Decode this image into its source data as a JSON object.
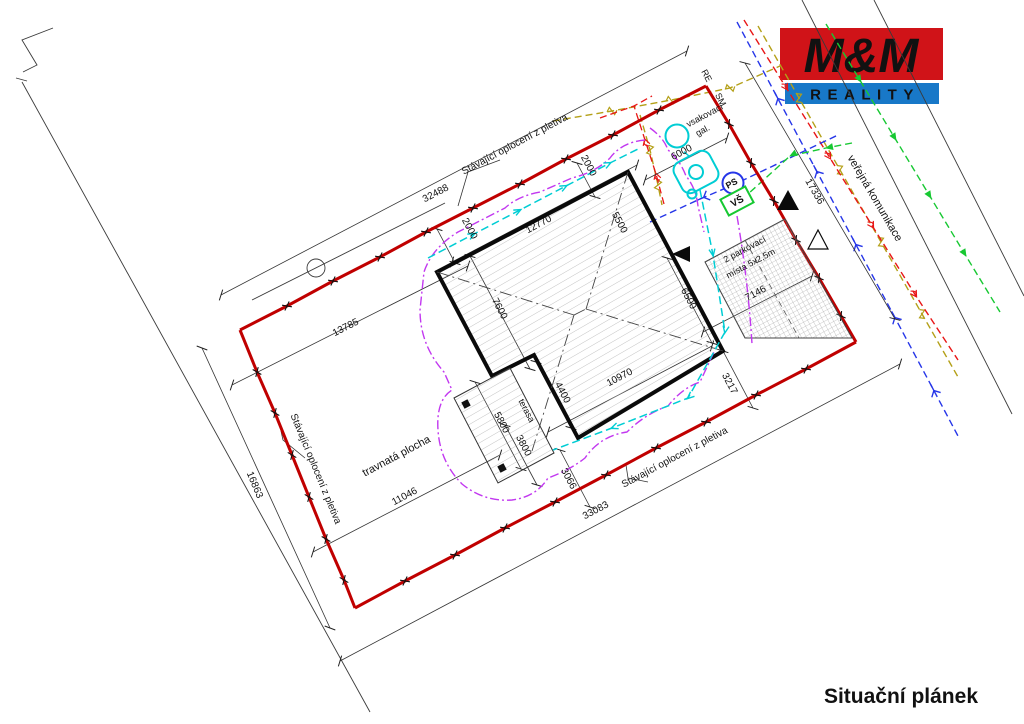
{
  "logo": {
    "top": "M&M",
    "bottom": "REALITY",
    "red": "#d01318",
    "blue": "#1878c8"
  },
  "title": "Situační plánek",
  "fence": {
    "label_top": "Stávající oplocení z pletiva",
    "label_left": "Stávající oplocení z pletiva",
    "label_bottom": "Stávající oplocení z pletiva",
    "color": "#c00000"
  },
  "areas": {
    "grass": "travnatá plocha",
    "road": "veřejná komunikace",
    "terrace": "terasa",
    "parking_line1": "2 parkovací",
    "parking_line2": "místa 5x2,5m",
    "soakaway_line1": "vsakovací",
    "soakaway_line2": "gal."
  },
  "markers": {
    "re": "RE",
    "sm": "SM",
    "ps": "PS",
    "vs": "VŠ"
  },
  "dims": {
    "boundary_top": "32488",
    "boundary_left": "16863",
    "boundary_bottom": "33083",
    "boundary_right": "17336",
    "d13785": "13785",
    "d11046": "11046",
    "d3066": "3066",
    "d3217": "3217",
    "d7146": "7146",
    "d6000": "6000",
    "d12770": "12770",
    "d5500": "5500",
    "d7600": "7600",
    "d6500": "6500",
    "d10970": "10970",
    "d4400": "4400",
    "d5800": "5800",
    "d3800": "3800",
    "gap_top": "2000",
    "gap_left": "2000"
  },
  "utilities": {
    "water_blue": "#2636e8",
    "drain_cyan": "#00cdd4",
    "gas_olive": "#b4a018",
    "electric_red": "#e81616",
    "green": "#17c832",
    "magenta": "#c238f0"
  }
}
